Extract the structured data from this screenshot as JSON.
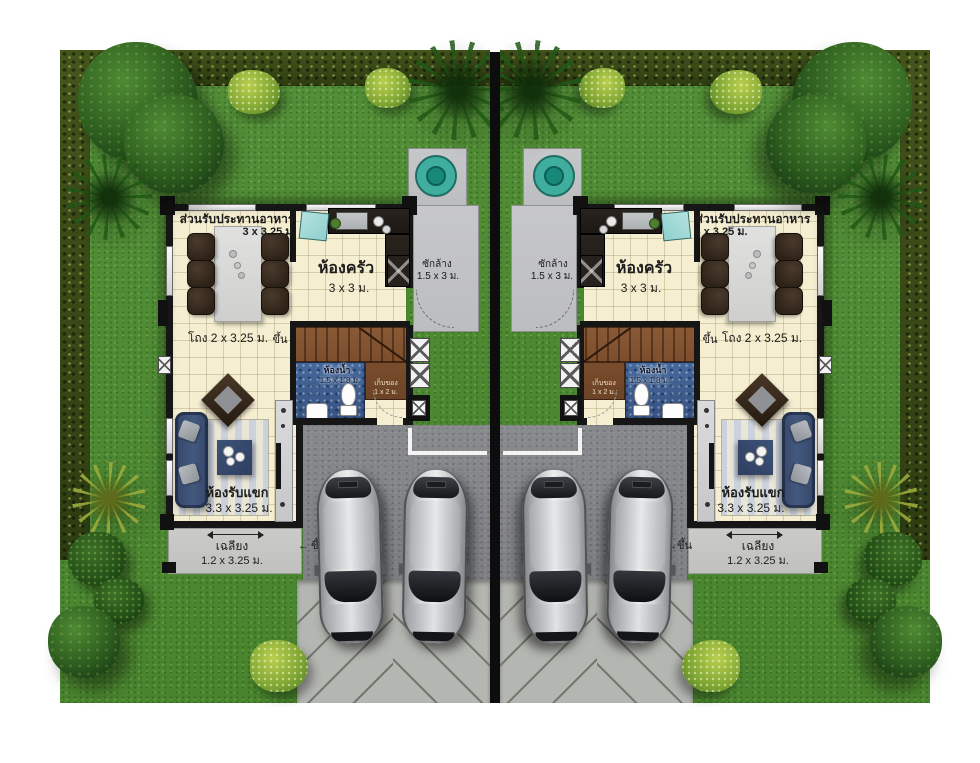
{
  "plan_title": "duplex-twin-house-floor-plan",
  "house": {
    "dining": {
      "name": "ส่วนรับประทานอาหาร",
      "dims": "3 x 3.25 ม."
    },
    "kitchen": {
      "name": "ห้องครัว",
      "dims": "3 x 3 ม."
    },
    "laundry": {
      "name": "ซักล้าง",
      "dims": "1.5 x 3 ม."
    },
    "hall": {
      "name": "โถง 2 x 3.25 ม."
    },
    "stairs_up": {
      "name": "ขึ้น"
    },
    "bathroom": {
      "name": "ห้องน้ำ",
      "dims": "1.5 x 1.8 ม."
    },
    "storage": {
      "name": "เก็บของ",
      "dims": "1 x 2 ม."
    },
    "living": {
      "name": "ห้องรับแขก",
      "dims": "3.3 x 3.25 ม."
    },
    "porch": {
      "name": "เฉลียง",
      "dims": "1.2 x 3.25 ม."
    },
    "porch_step": {
      "name": "ขึ้น"
    }
  },
  "colors": {
    "grass": "#55913a",
    "hedge": "#44551c",
    "floor": "#f5eed1",
    "wall": "#161616",
    "stair": "#8a5a36",
    "bath": "#46699c",
    "court": "#87898c",
    "drive": "#b4b6b1",
    "tank": "#3fae9e",
    "sofa": "#44597e",
    "label": "#1c1c1c"
  }
}
